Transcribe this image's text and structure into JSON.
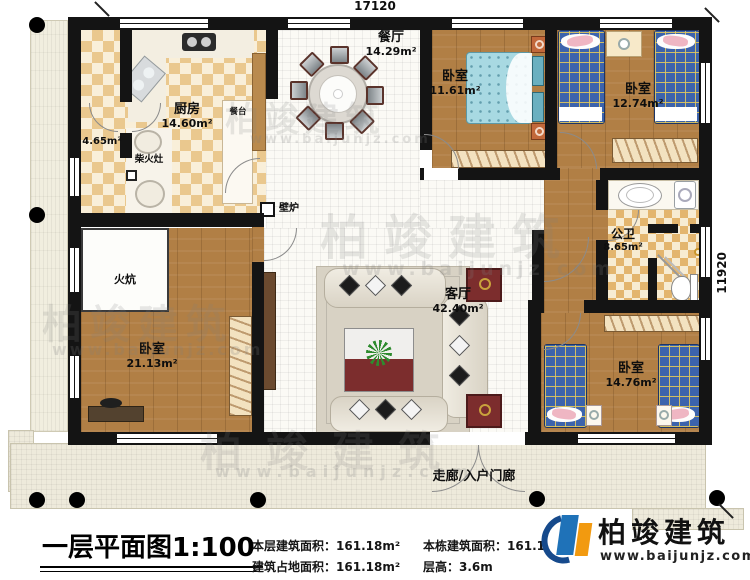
{
  "dimensions": {
    "top": "17120",
    "right": "11920"
  },
  "rooms": {
    "kitchen": {
      "name": "厨房",
      "area": "14.60m²"
    },
    "hall": {
      "area": "4.65m²"
    },
    "wood_stove": {
      "name": "柴火灶"
    },
    "counter": {
      "name": "餐台"
    },
    "dining": {
      "name": "餐厅",
      "area": "14.29m²"
    },
    "bedroom_top": {
      "name": "卧室",
      "area": "11.61m²"
    },
    "bedroom_topright": {
      "name": "卧室",
      "area": "12.74m²"
    },
    "bathroom": {
      "name": "公卫",
      "area": "8.65m²"
    },
    "living": {
      "name": "客厅",
      "area": "42.40m²"
    },
    "bedroom_left": {
      "name": "卧室",
      "area": "21.13m²"
    },
    "bedroom_bottomright": {
      "name": "卧室",
      "area": "14.76m²"
    },
    "kang": {
      "name": "火炕"
    },
    "fireplace": {
      "name": "壁炉"
    },
    "porch": {
      "name": "走廊/入户门廊"
    }
  },
  "footer": {
    "title": "一层平面图",
    "scale": "1:100",
    "stats": [
      {
        "label": "本层建筑面积：",
        "value": "161.18m²"
      },
      {
        "label": "本栋建筑面积：",
        "value": "161.1"
      },
      {
        "label": "建筑占地面积：",
        "value": "161.18m²"
      },
      {
        "label": "层高：",
        "value": "3.6m"
      }
    ]
  },
  "brand": {
    "name": "柏竣建筑",
    "url": "www.baijunjz.com"
  },
  "watermark": {
    "text": "柏竣建筑",
    "url": "www.baijunjz.com"
  },
  "colors": {
    "wall": "#141414",
    "wood": "#b17f45",
    "tile_tan": "#eac88e",
    "plaid_blue": "#3c63ac",
    "brand_blue": "#1f72b8",
    "brand_orange": "#f29a10",
    "accent_red": "#7c2d2d"
  }
}
